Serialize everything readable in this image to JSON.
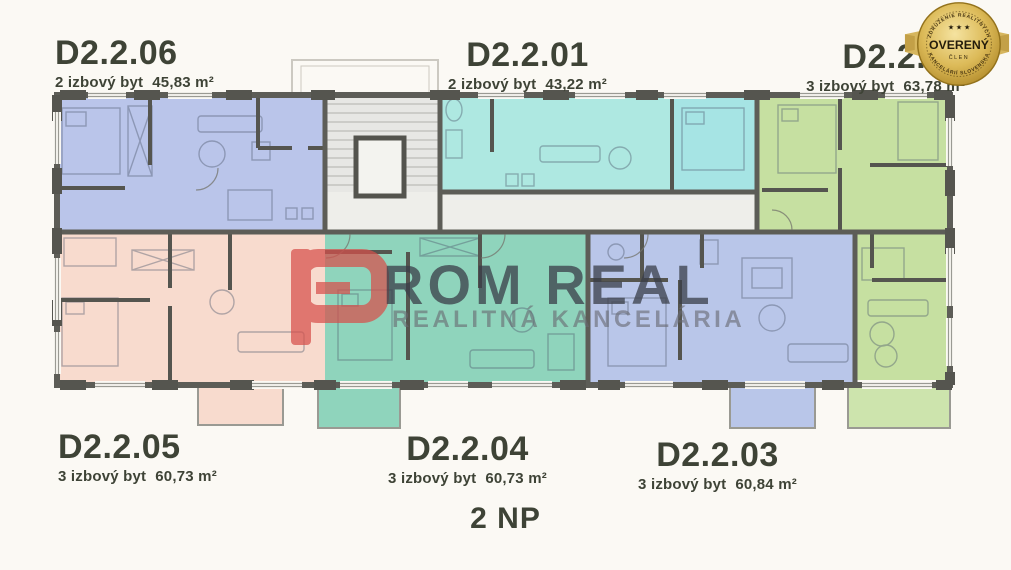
{
  "floor": {
    "label": "2 NP"
  },
  "apartments": [
    {
      "code": "D2.2.06",
      "desc": "2 izbový byt",
      "area": "45,83 m²",
      "color": "#bac5ea"
    },
    {
      "code": "D2.2.01",
      "desc": "2 izbový byt",
      "area": "43,22 m²",
      "color": "#aee8e1"
    },
    {
      "code": "D2.2.02",
      "desc": "3 izbový byt",
      "area": "63,78 m²",
      "color": "#c6e0a1"
    },
    {
      "code": "D2.2.05",
      "desc": "3 izbový byt",
      "area": "60,73 m²",
      "color": "#f8dbce"
    },
    {
      "code": "D2.2.04",
      "desc": "3 izbový byt",
      "area": "60,73 m²",
      "color": "#8fd4bc"
    },
    {
      "code": "D2.2.03",
      "desc": "3 izbový byt",
      "area": "60,84 m²",
      "color": "#b9c6e9"
    }
  ],
  "extra": {
    "bedroom_cyan": "#a6e4e4",
    "balcony_green": "#cde4ad"
  },
  "watermark": {
    "brand": "ROM REAL",
    "tagline": "REALITNÁ KANCELÁRIA",
    "logo_color": "#d7504b"
  },
  "badge": {
    "arc_top": "ZDRUŽENIE REALITNÝCH",
    "arc_bottom": "KANCELÁRIÍ SLOVENSKA",
    "stars": "★ ★ ★",
    "title": "OVERENÝ",
    "subtitle": "ČLEN",
    "gold": "#c9a43a"
  },
  "colors": {
    "background": "#fbf9f4",
    "wall": "#5d5d57",
    "corridor": "#ebebe8",
    "text": "#3e4336"
  }
}
